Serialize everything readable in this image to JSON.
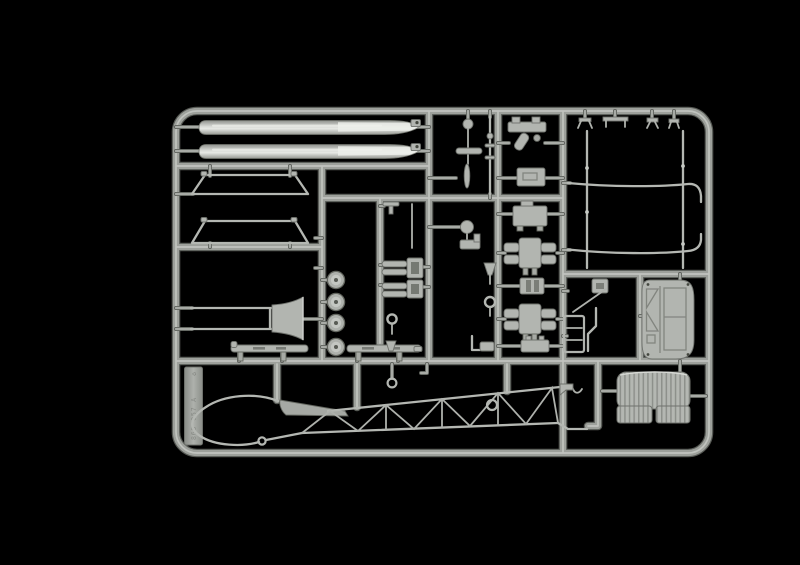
{
  "scene": {
    "type": "product-photo",
    "subject": "Injection-molded model kit sprue (helicopter parts) in light grey styrene centered on a black background",
    "background_color": "#000000"
  },
  "colors": {
    "background": "#000000",
    "runner_shadow": "#565954",
    "runner_base": "#9da09b",
    "runner_highlight": "#c9ccc7",
    "part_fill": "#b2b5b0",
    "part_shadow": "#6f726d",
    "blade_sheen": "#eceeea",
    "wheel_hub_dark": "#585b54"
  },
  "molded_tag": {
    "text": "869 057 A",
    "symbol": "♻"
  },
  "parts": [
    {
      "name": "main-rotor-blade",
      "qty": 2
    },
    {
      "name": "landing-skid-cross-frame",
      "qty": 2
    },
    {
      "name": "landing-skid-rail",
      "qty": 2
    },
    {
      "name": "road-wheel",
      "qty": 4
    },
    {
      "name": "tail-cone-fairing",
      "qty": 1
    },
    {
      "name": "rotor-mast",
      "qty": 1
    },
    {
      "name": "engine-crankcase-half",
      "qty": 2
    },
    {
      "name": "gearbox-block",
      "qty": 2
    },
    {
      "name": "engine-mount-bracket",
      "qty": 1
    },
    {
      "name": "canopy-frame-tube",
      "qty": 2
    },
    {
      "name": "frame-upright-rod",
      "qty": 2
    },
    {
      "name": "cabin-door-panel",
      "qty": 1
    },
    {
      "name": "bench-seat",
      "qty": 1
    },
    {
      "name": "canopy-bubble-frame",
      "qty": 1
    },
    {
      "name": "cockpit-floor-wedge",
      "qty": 1
    },
    {
      "name": "lattice-tail-boom",
      "qty": 1
    },
    {
      "name": "small-fittings",
      "qty": 18
    }
  ]
}
